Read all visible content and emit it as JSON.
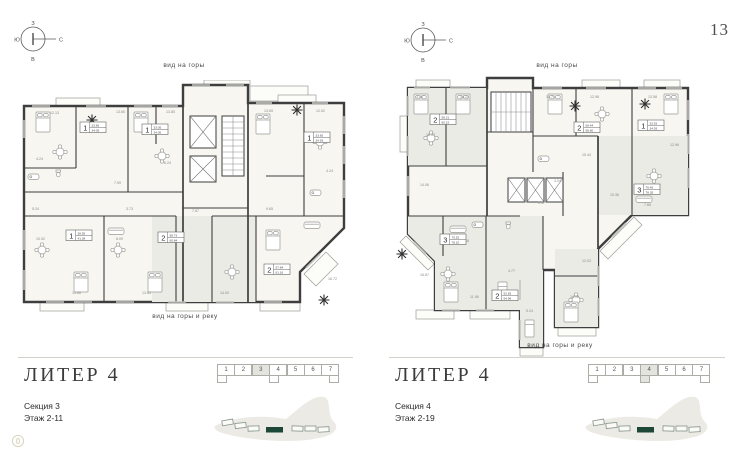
{
  "page": {
    "number": "13"
  },
  "compass": {
    "top": "З",
    "left": "Ю",
    "right": "С",
    "bottom": "В"
  },
  "colors": {
    "wall": "#3e3e3e",
    "accent_green": "#1d4737",
    "floor": "#f7f6f1",
    "highlight_cell": "#e4e4de"
  },
  "plans": [
    {
      "title": "ЛИТЕР 4",
      "section": "Секция 3",
      "floors": "Этаж 2-11",
      "view_top": "вид на горы",
      "view_bottom": "вид на горы и реку",
      "strip": {
        "cells": [
          "1",
          "2",
          "3",
          "4",
          "5",
          "6",
          "7"
        ],
        "active": 2,
        "tabs": [
          0,
          3,
          6
        ]
      },
      "tags": [
        {
          "x": 64,
          "y": 42,
          "r": "1",
          "a1": "33.65",
          "a2": "34.05"
        },
        {
          "x": 126,
          "y": 44,
          "r": "1",
          "a1": "33.05",
          "a2": "34.05"
        },
        {
          "x": 288,
          "y": 52,
          "r": "1",
          "a1": "33.65",
          "a2": "34.93"
        },
        {
          "x": 50,
          "y": 150,
          "r": "1",
          "a1": "38.55",
          "a2": "41.38"
        },
        {
          "x": 142,
          "y": 152,
          "r": "2",
          "a1": "58.73",
          "a2": "60.84"
        },
        {
          "x": 248,
          "y": 184,
          "r": "2",
          "a1": "57.84",
          "a2": "61.16"
        }
      ],
      "areas": [
        {
          "x": 34,
          "y": 34,
          "t": "12.13"
        },
        {
          "x": 100,
          "y": 33,
          "t": "13.65"
        },
        {
          "x": 150,
          "y": 33,
          "t": "13.85"
        },
        {
          "x": 248,
          "y": 32,
          "t": "13.65"
        },
        {
          "x": 300,
          "y": 32,
          "t": "12.52"
        },
        {
          "x": 20,
          "y": 80,
          "t": "4.24"
        },
        {
          "x": 98,
          "y": 104,
          "t": "7.59"
        },
        {
          "x": 148,
          "y": 84,
          "t": "6.24"
        },
        {
          "x": 310,
          "y": 92,
          "t": "4.24"
        },
        {
          "x": 16,
          "y": 130,
          "t": "5.24"
        },
        {
          "x": 20,
          "y": 160,
          "t": "10.92"
        },
        {
          "x": 56,
          "y": 214,
          "t": "13.66"
        },
        {
          "x": 110,
          "y": 130,
          "t": "3.73"
        },
        {
          "x": 100,
          "y": 160,
          "t": "8.09"
        },
        {
          "x": 126,
          "y": 214,
          "t": "13.64"
        },
        {
          "x": 204,
          "y": 214,
          "t": "14.00"
        },
        {
          "x": 250,
          "y": 130,
          "t": "9.65"
        },
        {
          "x": 312,
          "y": 200,
          "t": "16.72"
        },
        {
          "x": 176,
          "y": 132,
          "t": "7.67"
        }
      ]
    },
    {
      "title": "ЛИТЕР 4",
      "section": "Секция 4",
      "floors": "Этаж 2-19",
      "view_top": "вид на горы",
      "view_bottom": "вид на горы и реку",
      "strip": {
        "cells": [
          "1",
          "2",
          "3",
          "4",
          "5",
          "6",
          "7"
        ],
        "active": 3,
        "tabs": [
          0,
          3,
          6
        ]
      },
      "tags": [
        {
          "x": 44,
          "y": 38,
          "r": "2",
          "a1": "58.21",
          "a2": "60.15"
        },
        {
          "x": 188,
          "y": 46,
          "r": "2",
          "a1": "56.44",
          "a2": "58.60"
        },
        {
          "x": 252,
          "y": 44,
          "r": "1",
          "a1": "33.53",
          "a2": "34.93"
        },
        {
          "x": 248,
          "y": 108,
          "r": "3",
          "a1": "76.45",
          "a2": "78.35"
        },
        {
          "x": 54,
          "y": 158,
          "r": "3",
          "a1": "75.52",
          "a2": "78.10"
        },
        {
          "x": 106,
          "y": 214,
          "r": "2",
          "a1": "52.83",
          "a2": "54.96"
        }
      ],
      "areas": [
        {
          "x": 30,
          "y": 22,
          "t": "3.40"
        },
        {
          "x": 74,
          "y": 22,
          "t": "13.23"
        },
        {
          "x": 40,
          "y": 60,
          "t": "18.07"
        },
        {
          "x": 160,
          "y": 22,
          "t": "10.74"
        },
        {
          "x": 204,
          "y": 22,
          "t": "12.98"
        },
        {
          "x": 262,
          "y": 22,
          "t": "13.58"
        },
        {
          "x": 284,
          "y": 70,
          "t": "12.96"
        },
        {
          "x": 196,
          "y": 80,
          "t": "15.44"
        },
        {
          "x": 258,
          "y": 130,
          "t": "7.66"
        },
        {
          "x": 34,
          "y": 110,
          "t": "14.06"
        },
        {
          "x": 74,
          "y": 166,
          "t": "10.18"
        },
        {
          "x": 34,
          "y": 200,
          "t": "16.87"
        },
        {
          "x": 84,
          "y": 222,
          "t": "11.96"
        },
        {
          "x": 122,
          "y": 196,
          "t": "4.77"
        },
        {
          "x": 140,
          "y": 236,
          "t": "5.24"
        },
        {
          "x": 184,
          "y": 222,
          "t": "14.00"
        },
        {
          "x": 196,
          "y": 186,
          "t": "12.03"
        },
        {
          "x": 224,
          "y": 120,
          "t": "10.36"
        },
        {
          "x": 152,
          "y": 128,
          "t": "2.57"
        },
        {
          "x": 168,
          "y": 106,
          "t": "4.04"
        }
      ]
    }
  ]
}
